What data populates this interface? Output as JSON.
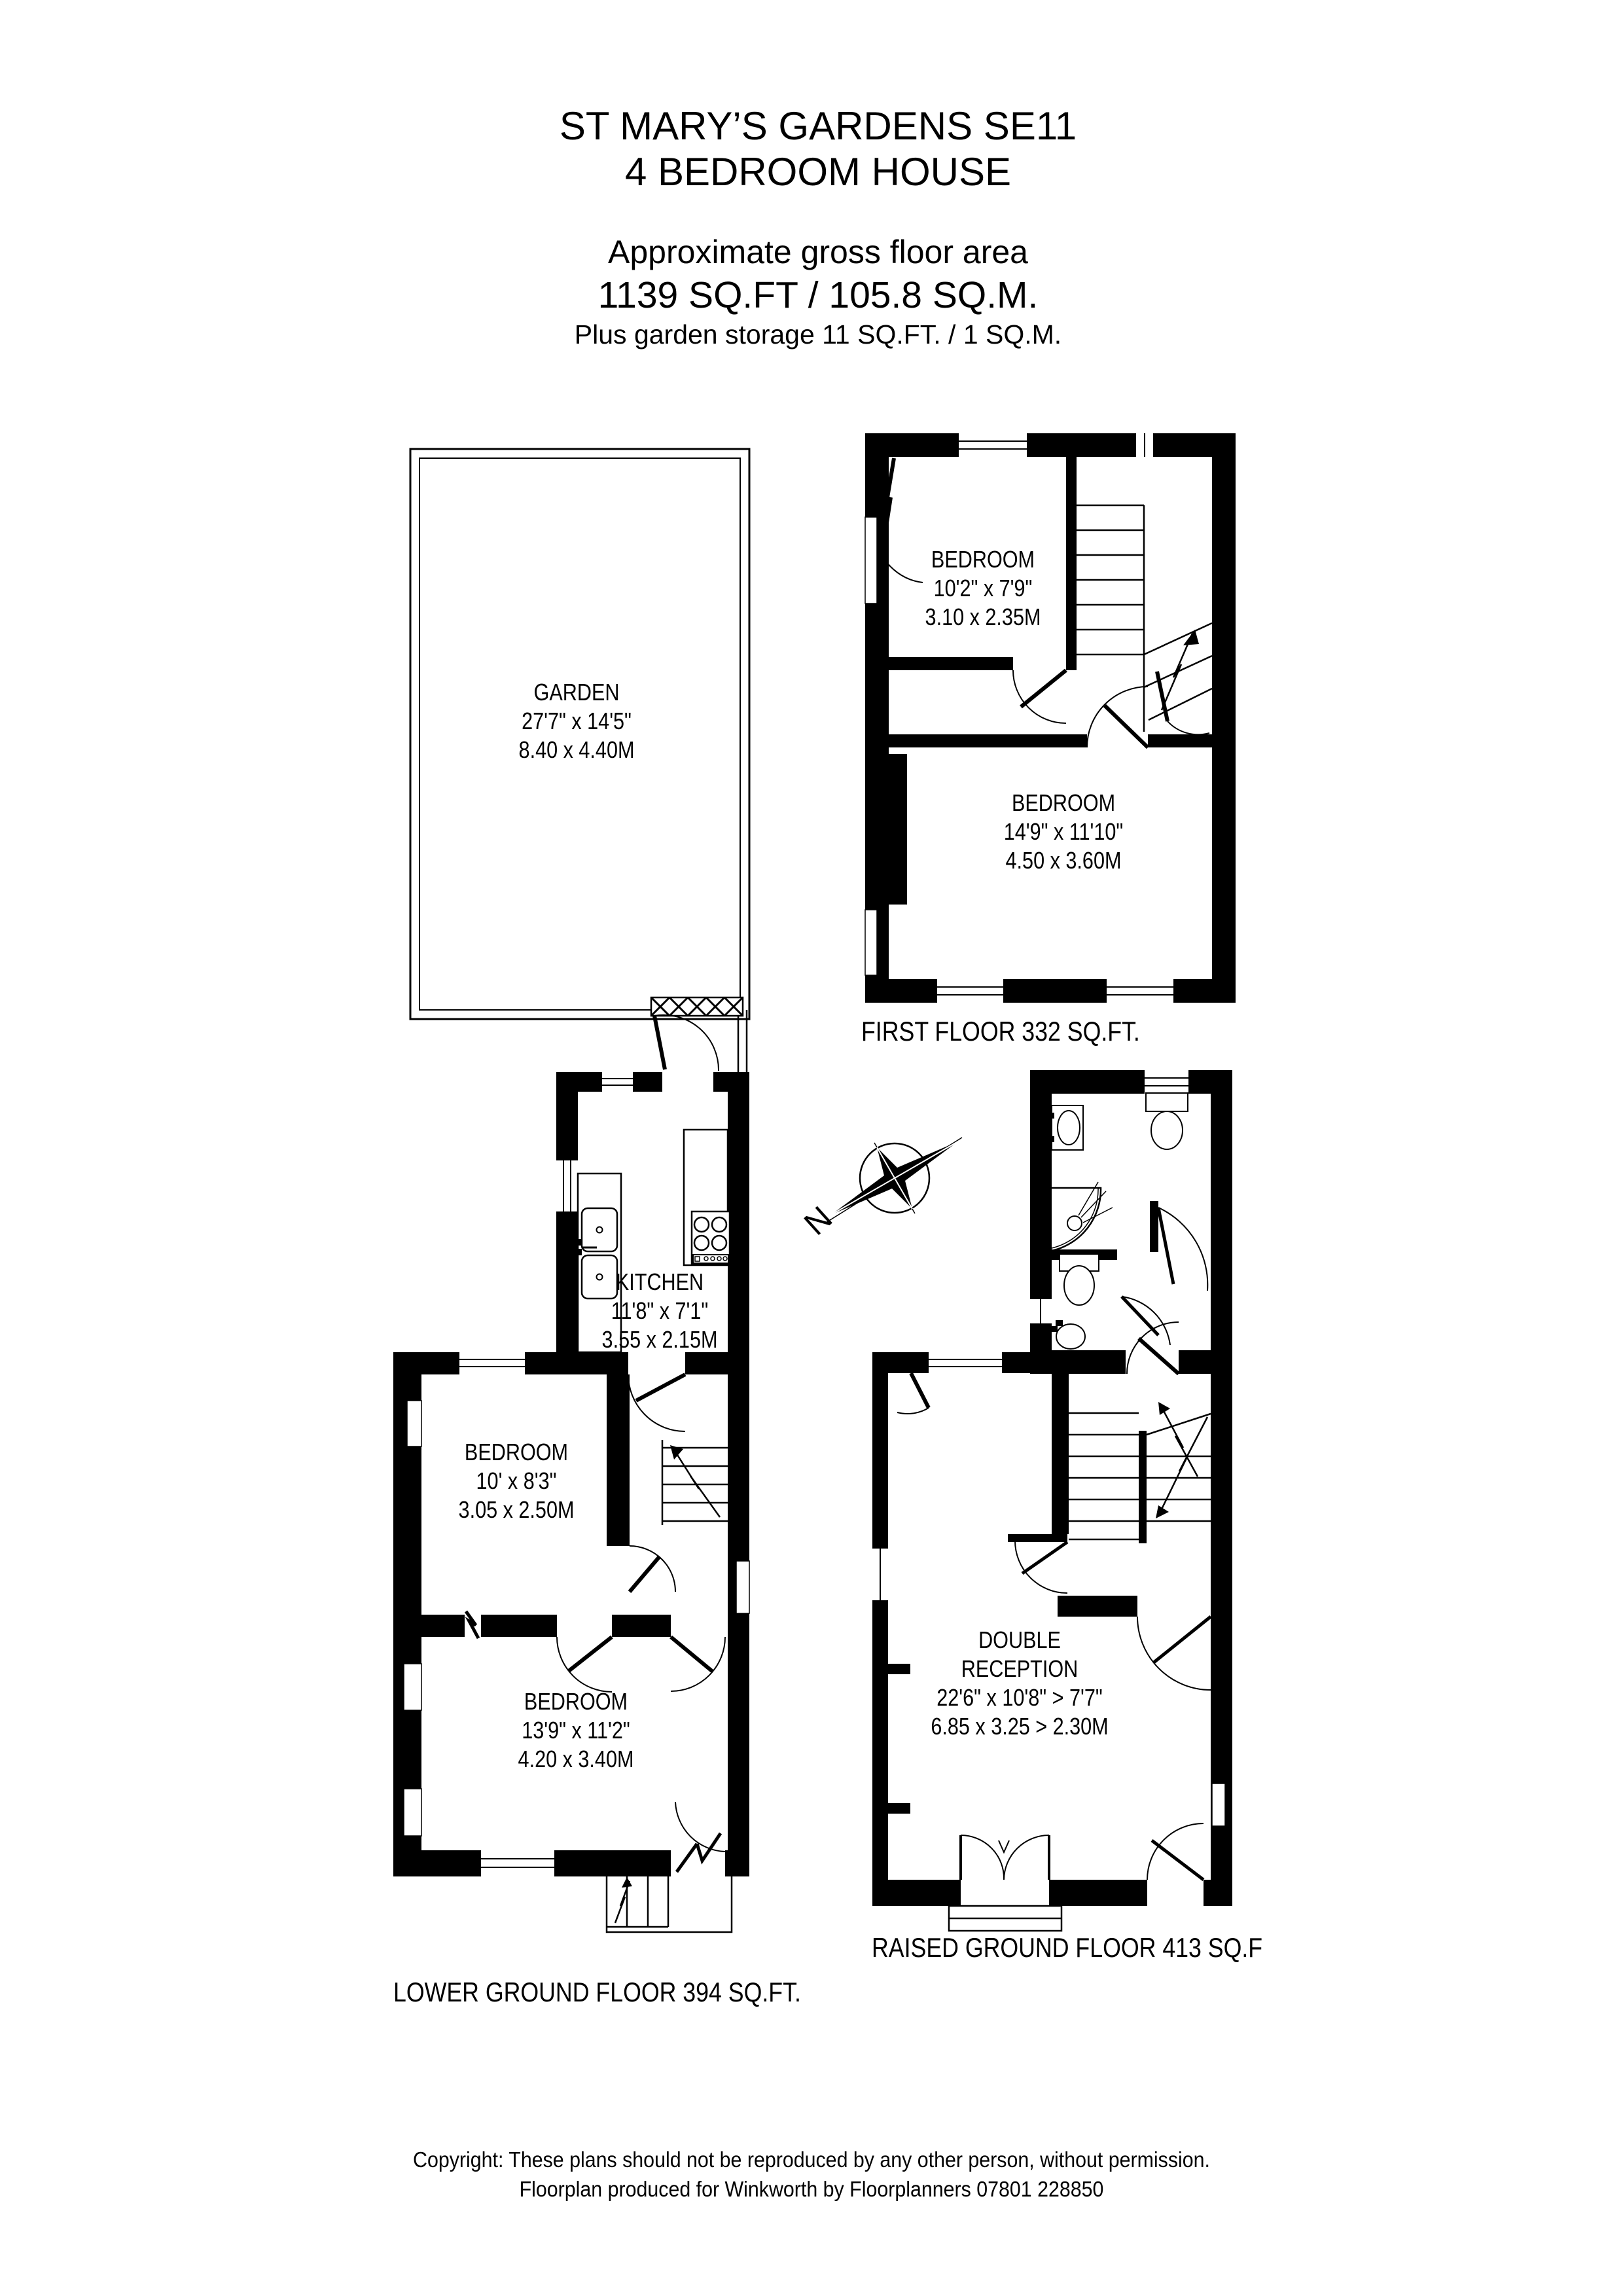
{
  "title_block": {
    "line1": "ST MARY’S GARDENS SE11",
    "line2": "4 BEDROOM HOUSE",
    "area_heading": "Approximate gross floor area",
    "area_value": "1139 SQ.FT / 105.8 SQ.M.",
    "area_note": "Plus garden storage 11 SQ.FT. / 1 SQ.M."
  },
  "garden": {
    "name": "GARDEN",
    "imperial": "27'7\" x 14'5\"",
    "metric": "8.40 x 4.40M"
  },
  "first_floor": {
    "caption": "FIRST FLOOR 332 SQ.FT.",
    "bedroom_small": {
      "name": "BEDROOM",
      "imperial": "10'2\" x 7'9\"",
      "metric": "3.10 x 2.35M"
    },
    "bedroom_large": {
      "name": "BEDROOM",
      "imperial": "14'9\" x 11'10\"",
      "metric": "4.50 x 3.60M"
    }
  },
  "lower_ground_floor": {
    "caption": "LOWER GROUND FLOOR 394 SQ.FT.",
    "kitchen": {
      "name": "KITCHEN",
      "imperial": "11'8\" x 7'1\"",
      "metric": "3.55 x 2.15M"
    },
    "bedroom_middle": {
      "name": "BEDROOM",
      "imperial": "10' x 8'3\"",
      "metric": "3.05 x 2.50M"
    },
    "bedroom_front": {
      "name": "BEDROOM",
      "imperial": "13'9\" x 11'2\"",
      "metric": "4.20 x 3.40M"
    }
  },
  "raised_ground_floor": {
    "caption": "RAISED GROUND FLOOR 413 SQ.F",
    "double_reception": {
      "name_line1": "DOUBLE",
      "name_line2": "RECEPTION",
      "imperial": "22'6\" x 10'8\" > 7'7\"",
      "metric": "6.85 x 3.25 > 2.30M"
    }
  },
  "compass": {
    "north": "N"
  },
  "footer": {
    "line1": "Copyright: These plans should not be reproduced by any other person, without permission.",
    "line2": "Floorplan produced for Winkworth by Floorplanners 07801 228850"
  }
}
